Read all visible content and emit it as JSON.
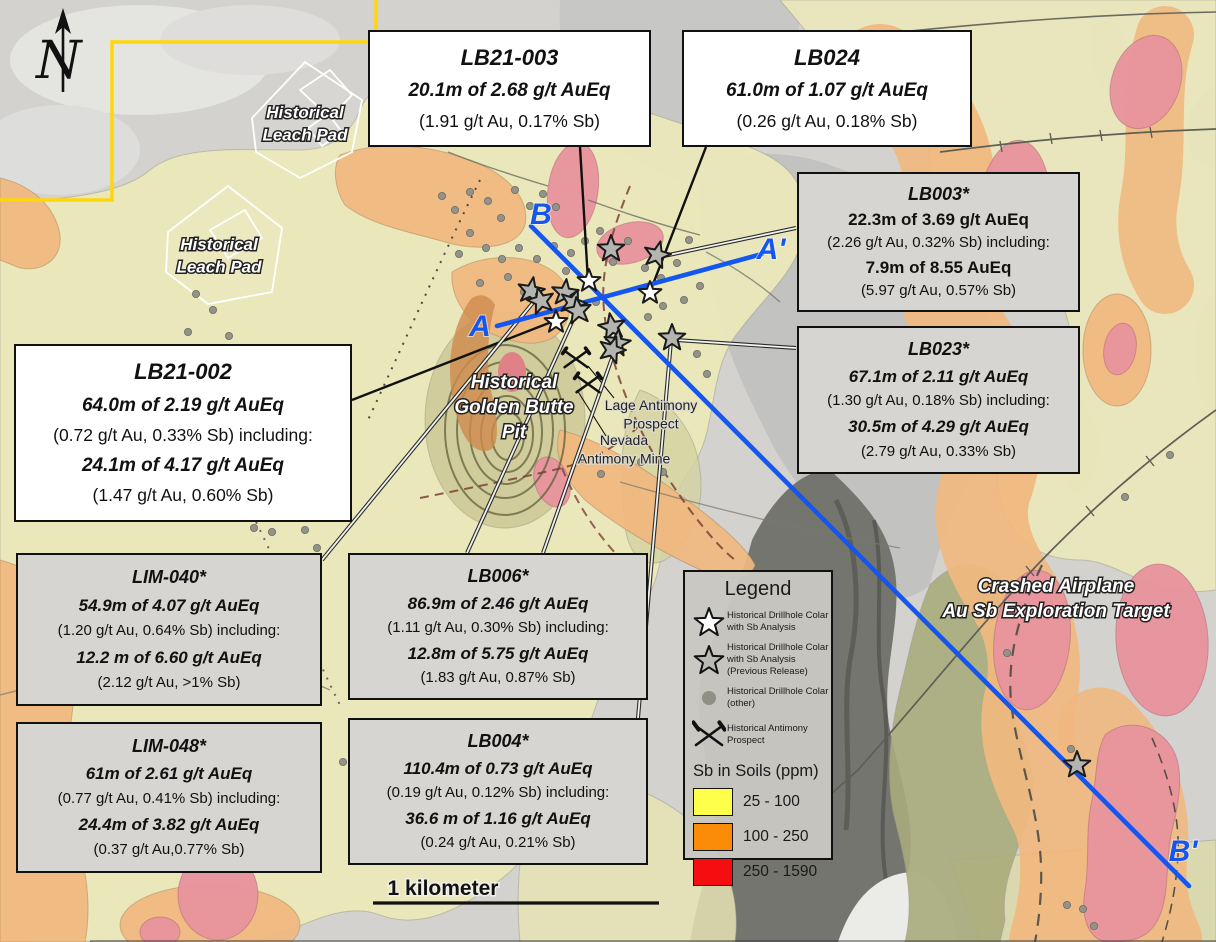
{
  "figure_title": "Golden Butte drill results map",
  "north": {
    "letter": "N"
  },
  "scale": {
    "label": "1 kilometer"
  },
  "accent_colors": {
    "section_line_blue": "#1456f0",
    "claim_boundary_yellow": "#ffd60a"
  },
  "callouts": [
    {
      "id": "LB21-003",
      "variant": "white",
      "fs": "lg",
      "x": 368,
      "y": 30,
      "w": 283,
      "h": 117,
      "title": "LB21-003",
      "lines": [
        {
          "t": "20.1m of 2.68 g/t AuEq",
          "s": "bi"
        },
        {
          "t": "(1.91 g/t Au, 0.17% Sb)",
          "s": "r"
        }
      ]
    },
    {
      "id": "LB024",
      "variant": "white",
      "fs": "lg",
      "x": 682,
      "y": 30,
      "w": 290,
      "h": 117,
      "title": "LB024",
      "lines": [
        {
          "t": "61.0m of 1.07 g/t AuEq",
          "s": "bi"
        },
        {
          "t": "(0.26 g/t Au, 0.18% Sb)",
          "s": "r"
        }
      ]
    },
    {
      "id": "LB003",
      "variant": "gray",
      "fs": "sm",
      "x": 797,
      "y": 172,
      "w": 283,
      "h": 140,
      "title": "LB003*",
      "lines": [
        {
          "t": "22.3m of 3.69 g/t AuEq",
          "s": "b"
        },
        {
          "t": "(2.26 g/t Au, 0.32% Sb) including:",
          "s": "r"
        },
        {
          "t": "7.9m of 8.55 AuEq",
          "s": "b"
        },
        {
          "t": "(5.97 g/t Au, 0.57% Sb)",
          "s": "r"
        }
      ]
    },
    {
      "id": "LB023",
      "variant": "gray",
      "fs": "sm",
      "x": 797,
      "y": 326,
      "w": 283,
      "h": 148,
      "title": "LB023*",
      "lines": [
        {
          "t": "67.1m of 2.11 g/t AuEq",
          "s": "bi"
        },
        {
          "t": "(1.30 g/t Au, 0.18% Sb) including:",
          "s": "r"
        },
        {
          "t": "30.5m of 4.29 g/t AuEq",
          "s": "bi"
        },
        {
          "t": "(2.79 g/t Au, 0.33% Sb)",
          "s": "r"
        }
      ]
    },
    {
      "id": "LB21-002",
      "variant": "white",
      "fs": "lg",
      "x": 14,
      "y": 344,
      "w": 338,
      "h": 178,
      "title": "LB21-002",
      "lines": [
        {
          "t": "64.0m of 2.19 g/t AuEq",
          "s": "bi"
        },
        {
          "t": "(0.72 g/t Au, 0.33% Sb) including:",
          "s": "r"
        },
        {
          "t": "24.1m of 4.17 g/t AuEq",
          "s": "bi"
        },
        {
          "t": "(1.47 g/t Au, 0.60% Sb)",
          "s": "r"
        }
      ]
    },
    {
      "id": "LIM-040",
      "variant": "gray",
      "fs": "sm",
      "x": 16,
      "y": 553,
      "w": 306,
      "h": 153,
      "title": "LIM-040*",
      "lines": [
        {
          "t": "54.9m of 4.07 g/t AuEq",
          "s": "bi"
        },
        {
          "t": "(1.20 g/t Au, 0.64% Sb) including:",
          "s": "r"
        },
        {
          "t": "12.2 m of 6.60 g/t AuEq",
          "s": "bi"
        },
        {
          "t": "(2.12 g/t Au, >1% Sb)",
          "s": "r"
        }
      ]
    },
    {
      "id": "LB006",
      "variant": "gray",
      "fs": "sm",
      "x": 348,
      "y": 553,
      "w": 300,
      "h": 147,
      "title": "LB006*",
      "lines": [
        {
          "t": "86.9m of 2.46 g/t AuEq",
          "s": "bi"
        },
        {
          "t": "(1.11 g/t Au, 0.30% Sb) including:",
          "s": "r"
        },
        {
          "t": "12.8m of 5.75 g/t AuEq",
          "s": "bi"
        },
        {
          "t": "(1.83 g/t Au, 0.87% Sb)",
          "s": "r"
        }
      ]
    },
    {
      "id": "LIM-048",
      "variant": "gray",
      "fs": "sm",
      "x": 16,
      "y": 722,
      "w": 306,
      "h": 151,
      "title": "LIM-048*",
      "lines": [
        {
          "t": "61m of 2.61 g/t AuEq",
          "s": "bi"
        },
        {
          "t": "(0.77 g/t Au, 0.41% Sb) including:",
          "s": "r"
        },
        {
          "t": "24.4m of 3.82 g/t AuEq",
          "s": "bi"
        },
        {
          "t": "(0.37 g/t Au,0.77% Sb)",
          "s": "r"
        }
      ]
    },
    {
      "id": "LB004",
      "variant": "gray",
      "fs": "sm",
      "x": 348,
      "y": 718,
      "w": 300,
      "h": 147,
      "title": "LB004*",
      "lines": [
        {
          "t": "110.4m of 0.73 g/t AuEq",
          "s": "bi"
        },
        {
          "t": "(0.19 g/t Au, 0.12% Sb) including:",
          "s": "r"
        },
        {
          "t": "36.6 m of 1.16 g/t AuEq",
          "s": "bi"
        },
        {
          "t": "(0.24 g/t Au, 0.21% Sb)",
          "s": "r"
        }
      ]
    }
  ],
  "legend": {
    "title": "Legend",
    "x": 683,
    "y": 570,
    "w": 150,
    "h": 290,
    "items": [
      {
        "icon": "star-white",
        "lines": [
          "Historical Drillhole Colar",
          "with Sb Analysis"
        ]
      },
      {
        "icon": "star-gray",
        "lines": [
          "Historical Drillhole Colar",
          "with Sb Analysis",
          "(Previous Release)"
        ]
      },
      {
        "icon": "dot",
        "lines": [
          "Historical Drillhole Colar",
          "(other)"
        ]
      },
      {
        "icon": "hammers",
        "lines": [
          "Historical Antimony",
          "Prospect"
        ]
      }
    ],
    "soils_title": "Sb in Soils (ppm)",
    "swatches": [
      {
        "color": "#fdff4a",
        "label": "25 - 100"
      },
      {
        "color": "#fb8c07",
        "label": "100 - 250"
      },
      {
        "color": "#f60d0f",
        "label": "250 - 1590"
      }
    ]
  },
  "map_labels": [
    {
      "id": "leach-pad-1",
      "style": "white",
      "size": 17,
      "x": 305,
      "y": 118,
      "lines": [
        "Historical",
        "Leach Pad"
      ]
    },
    {
      "id": "leach-pad-2",
      "style": "white",
      "size": 17,
      "x": 219,
      "y": 250,
      "lines": [
        "Historical",
        "Leach Pad"
      ]
    },
    {
      "id": "golden-butte-pit",
      "style": "white",
      "size": 19,
      "x": 514,
      "y": 388,
      "lines": [
        "Historical",
        "Golden Butte",
        "Pit"
      ]
    },
    {
      "id": "lage-antimony-prospect",
      "style": "dark",
      "size": 14,
      "x": 651,
      "y": 410,
      "lines": [
        "Lage Antimony",
        "Prospect"
      ]
    },
    {
      "id": "nevada-antimony-mine",
      "style": "dark",
      "size": 14,
      "x": 624,
      "y": 445,
      "lines": [
        "Nevada",
        "Antimony Mine"
      ]
    },
    {
      "id": "crashed-airplane",
      "style": "white",
      "size": 19,
      "x": 1056,
      "y": 592,
      "lines": [
        "Crashed Airplane",
        "Au Sb Exploration Target"
      ]
    }
  ],
  "section_labels": [
    {
      "t": "B",
      "x": 541,
      "y": 224
    },
    {
      "t": "A'",
      "x": 771,
      "y": 259
    },
    {
      "t": "A",
      "x": 480,
      "y": 336
    },
    {
      "t": "B'",
      "x": 1183,
      "y": 861
    }
  ],
  "markers": {
    "stars_white": [
      [
        589,
        281
      ],
      [
        650,
        293
      ],
      [
        556,
        322
      ]
    ],
    "stars_gray": [
      [
        531,
        291,
        10
      ],
      [
        541,
        301,
        -14
      ],
      [
        565,
        293,
        6
      ],
      [
        573,
        303,
        20
      ],
      [
        578,
        311,
        -8
      ],
      [
        611,
        249,
        0
      ],
      [
        657,
        255,
        14
      ],
      [
        612,
        327,
        -10
      ],
      [
        617,
        343,
        8
      ],
      [
        612,
        350,
        18
      ],
      [
        672,
        338,
        0
      ],
      [
        1077,
        765,
        0
      ]
    ],
    "hammers": [
      [
        576,
        359
      ],
      [
        588,
        384
      ]
    ],
    "dots": [
      [
        442,
        196
      ],
      [
        455,
        210
      ],
      [
        470,
        192
      ],
      [
        488,
        201
      ],
      [
        501,
        218
      ],
      [
        515,
        190
      ],
      [
        530,
        206
      ],
      [
        543,
        194
      ],
      [
        556,
        207
      ],
      [
        470,
        233
      ],
      [
        486,
        248
      ],
      [
        459,
        254
      ],
      [
        502,
        259
      ],
      [
        519,
        248
      ],
      [
        537,
        259
      ],
      [
        554,
        246
      ],
      [
        571,
        253
      ],
      [
        585,
        241
      ],
      [
        600,
        231
      ],
      [
        613,
        262
      ],
      [
        628,
        241
      ],
      [
        645,
        268
      ],
      [
        661,
        278
      ],
      [
        677,
        263
      ],
      [
        689,
        240
      ],
      [
        508,
        277
      ],
      [
        480,
        283
      ],
      [
        524,
        292
      ],
      [
        596,
        302
      ],
      [
        648,
        317
      ],
      [
        663,
        306
      ],
      [
        684,
        300
      ],
      [
        700,
        286
      ],
      [
        566,
        271
      ],
      [
        196,
        294
      ],
      [
        213,
        310
      ],
      [
        188,
        332
      ],
      [
        229,
        336
      ],
      [
        203,
        362
      ],
      [
        245,
        364
      ],
      [
        221,
        390
      ],
      [
        257,
        392
      ],
      [
        238,
        418
      ],
      [
        269,
        442
      ],
      [
        251,
        464
      ],
      [
        281,
        472
      ],
      [
        262,
        496
      ],
      [
        291,
        504
      ],
      [
        305,
        530
      ],
      [
        272,
        532
      ],
      [
        317,
        548
      ],
      [
        254,
        528
      ],
      [
        697,
        354
      ],
      [
        707,
        374
      ],
      [
        641,
        462
      ],
      [
        663,
        472
      ],
      [
        601,
        474
      ],
      [
        352,
        750
      ],
      [
        343,
        762
      ],
      [
        361,
        774
      ],
      [
        1067,
        905
      ],
      [
        1083,
        909
      ],
      [
        1094,
        926
      ],
      [
        1071,
        749
      ],
      [
        1007,
        653
      ],
      [
        1125,
        497
      ],
      [
        1170,
        455
      ]
    ]
  }
}
